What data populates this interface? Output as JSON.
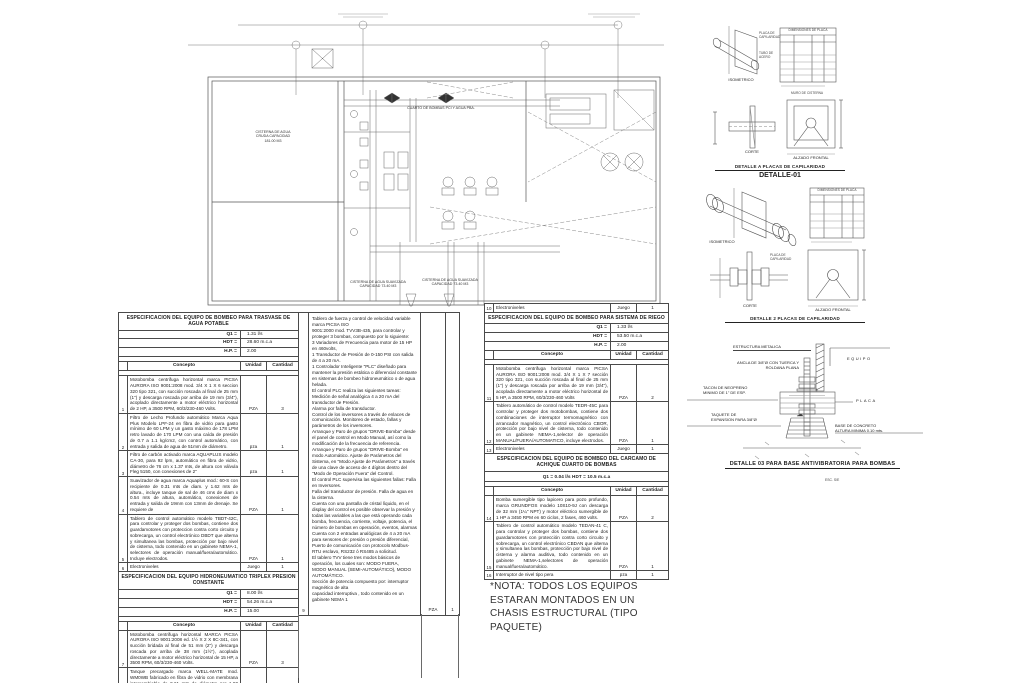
{
  "plan": {
    "cuarto": "CUARTO DE BOMBAS  PCI Y  AGUA PBA.",
    "cisterna_cruda": "CISTERNA DE AGUA\nCRUDA  CAPACIDAD\n181.00 M3",
    "cisterna_suav_1": "CISTERNA DE AGUA SUAVIZADA\nCAPACIDAD 73.40 M3",
    "cisterna_suav_2": "CISTERNA DE AGUA SUAVIZADA\nCAPACIDAD 73.40 M3"
  },
  "t1": {
    "title": "ESPECIFICACION DEL EQUIPO DE BOMBEO PARA TRASVASE DE  AGUA POTABLE",
    "q1l": "Q1 =",
    "q1": "1.31 l/s",
    "hdtl": "HDT =",
    "hdt": "28.60 m.c.a",
    "hpl": "H.P. =",
    "hp": "2.00",
    "hc": "Concepto",
    "hu": "Unidad",
    "hq": "Cantidad",
    "rows": [
      {
        "num": "1",
        "con": "Motobomba centrifuga horizontal marca PICSA AURORA ISO 9001:2008 mod. 3/4 X 1 X 6 seccion 320 tipo 321, con succión roscada al final de 25 mm (1\") y descarga roscada por arriba de 19 mm (3/4\"), acoplado directamente a motor eléctrico horizontal de 2 HP, a 3500 RPM, 60/3/230-460 Volts.",
        "uni": "PZA",
        "qty": "3"
      },
      {
        "num": "2",
        "con": "Filtro de Lecho Profundo automático Marca Aqua Plus Modelo LPF-24 en fibra de vidrio para gasto mínimo de 60 LPM y un gasto máximo de 178 LPM retro lavado de 170 LPM con una caída de presión de 0.7 a 1.1 kg/cm2, con control automático, con entrada y salida de agua de 51mm de diámetro.",
        "uni": "pza",
        "qty": "1"
      },
      {
        "num": "3",
        "con": "Filtro de carbón activado marca AQUAPLUS modelo CA-30, para 92 lpm, automático en fibra de vidrio, diámetro de 76 cm x 1.37 mts, de altura con válvula Fleg 5150, con conexiones de 2\"",
        "uni": "pza",
        "qty": "1"
      },
      {
        "num": "4",
        "con": "Suavizador de agua marca Aquaplus mod.: 60-S con recipiente de 0.31 mts de diam. y 1.62 mts de altura., incluye tanque de sal de 46 cms de diam x 0.54 mts de altura, automático, conexiones de entrada y salida de 19mm con 13mm de drenaje. Se requiere de",
        "uni": "PZA",
        "qty": "1"
      },
      {
        "num": "5",
        "con": "Tablero de control automático modelo TBDT-42C, para controlar y proteger dos bombas, contiene dos guardamotores con proteccion contra corto circuito y sobrecarga, un control electrónico DBDT que alterna y simultanea las bombas, protección por bajo nivel de cisterna, todo contenido en un gabinete NEMA-1, selectores de operación manual/fuera/automático. Incluye electrodos.",
        "uni": "PZA",
        "qty": "1"
      },
      {
        "num": "6",
        "con": "Electroniveles",
        "uni": "Juego",
        "qty": "1"
      }
    ]
  },
  "t2": {
    "title": "ESPECIFICACION DEL EQUIPO HIDRONEUMATICO TRIPLEX PRESION CONSTANTE",
    "q1l": "Q1 =",
    "q1": "8.00 l/s",
    "hdtl": "HDT =",
    "hdt": "54.26 m.c.a",
    "hpl": "H.P. =",
    "hp": "15.00",
    "hc": "Concepto",
    "hu": "Unidad",
    "hq": "Cantidad",
    "rows": [
      {
        "num": "7",
        "con": "Motobomba centrifuga horizontal MARCA PICSA AURORA ISO 9001:2008 ed. 1½ X 2 X 8C-341, con succión bridada al final de 51 mm (2\") y descarga roscada por arriba de 38 mm (1½\"), acoplada directamente a motor eléctrico horizontal de 15 HP, a 3500 RPM, 60/3/230-460 Volts.",
        "uni": "PZA",
        "qty": "3"
      },
      {
        "num": "8",
        "con": "Tanque precargado marca WELL-MATE mod. WM0WB fabricado en fibra de vidrio con membrana intercambiable de 0.61 mts de diámetro por 1.80 mts. de altura para una presión máxima de 8.8 kg/cm2 (125 psig), conexión del sistema de 1-1/4\"NPT y capacidad nominal de 450 lts.",
        "uni": "pza",
        "qty": "1"
      }
    ]
  },
  "mid": {
    "num": "9",
    "uni": "PZA",
    "qty": "1",
    "text": "Tablero de fuerza y control de velocidad variable marca PICSA ISO\n9001:2000 mod. TVV3B-435, para controlar y proteger 3 bombas, compuesto por lo siguiente:\n3 Variadores de Frecuencia para motor de 15 HP en 460volts,\n1 Transductor de Presión de 0-150 PSI con salida de 4 a 20 mA.\n1 Controlador Inteligente \"PLC\" diseñado para mantener la presión estática o diferencial constante en sistemas de bombeo hidroneumático o de agua helada.\nEl control PLC realiza las siguientes tareas:\nMedición de señal analógica 4 a 20 mA del transductor de Presión.\nAlarma por falla de transductor.\nControl de los inversores a través de enlaces de comunicación. Monitoreo de estado, fallas y parámetros de los inversores.\nArranque y Paro de grupos \"DRIVE-Bomba\" desde el panel de control en Modo  Manual, así como la modificación de la frecuencia de referencia.\nArranque y Paro de grupos \"DRIVE-Bomba\" en modo Automático. Ajuste de Parámetros del Sistema, en \"Modo Ajuste de Parámetros\" a través de una clave de acceso de 4 dígitos dentro del \"Modo de Operación Fuera\" del Control.\nEl control PLC supervisa las siguientes fallas: Falla en Inversores.\nFalla del transductor de presión. Falla de agua en la cisterna.\nCuenta con una pantalla de cristal líquido, en el display del control es posible observar la presión y todas las variables a las que está operando cada bomba, frecuencia, corriente, voltaje, potencia, el número de bombas en operación, eventos, alarmas Cuenta con 2 entradas analógicas de 4 a 20 mA para sensores de: presión o presión diferencial, Puerto de comunicación con protocolo Modbus-RTU esclavo, RS232 ó RS485 a solicitud.\nEl tablero TVV tiene tres modos básicos de operación, los cuales son: MODO FUERA,\nMODO MANUAL (SEMI-AUTOMÁTICO), MODO AUTOMÁTICO.\nSección de potencia compuesto por: interruptor magnético de alta\ncapacidad interruptiva , todo contenido en un gabinete NEMA 1"
  },
  "t3": {
    "pre": {
      "num": "10",
      "con": "Electroniveles",
      "uni": "Juego",
      "qty": "1"
    },
    "title": "ESPECIFICACION DEL EQUIPO DE BOMBEO PARA SISTEMA DE RIEGO",
    "q1l": "Q1 =",
    "q1": "1.33 l/s",
    "hdtl": "HDT =",
    "hdt": "53.50 m.c.a",
    "hpl": "H.P. =",
    "hp": "2.00",
    "hc": "Concepto",
    "hu": "Unidad",
    "hq": "Cantidad",
    "rows": [
      {
        "num": "11",
        "con": "Motobomba centrifuga horizontal marca PICSA AURORA ISO 9001:2008 mod. 3/4 X 1 X 7 sección 320 tipo 321, con succión roscada al final de 25 mm (1\") y descarga roscada por arriba de 19 mm (3/4\"), acoplada directamente a motor eléctrico horizontal de 5 HP, a 3500 RPM, 60/3/230-460 Volts",
        "uni": "PZA",
        "qty": "2"
      },
      {
        "num": "12",
        "con": "Tablero automático de control modelo TEDR-45C para controlar y proteger dos motobombas, contiene dos combinaciones de interruptor termomagnético con arrancador magnético, un control electrónico CBOR, protección por bajo nivel de cisterna, todo contenido en un gabinete NEMA-1,selector de operación MANUAL/FUERA/AUTOMATICO, incluye electrodos.",
        "uni": "PZA",
        "qty": "1"
      },
      {
        "num": "13",
        "con": "Electroniveles",
        "uni": "Juego",
        "qty": "1"
      }
    ]
  },
  "t4": {
    "title": "ESPECIFICACION DEL EQUIPO DE BOMBEO DEL CARCAMO  DE ACHIQUE CUARTO DE BOMBAS",
    "params": "Q1 =  0.04 l/s HDT = 10.5 m.c.a",
    "hc": "Concepto",
    "hu": "Unidad",
    "hq": "Cantidad",
    "rows": [
      {
        "num": "14",
        "con": "Bomba sumergible tipo lapicero para pozo profundo, marca GRUNDFOS modelo 10S10-9J con descarga de 32 mm (1¼\" NPT) y motor eléctrico sumergible de 1 HP a 3450 RPM en 60 ciclos, 2 fases, 460 volts.",
        "uni": "PZA",
        "qty": "2"
      },
      {
        "num": "15",
        "con": "Tablero de control automático modelo TEDAN-41 C, para controlar y proteger dos bombas, contiene dos guardamotores con protección contra corto circuito y sobrecarga, un control electrónico CBDAN que alterna y simultanea las bombas, protección por bajo nivel de cisterna y alarma auditiva, todo contenido en un gabinete NEMA-1,selectores de operación manual/fuera/automático.",
        "uni": "PZA",
        "qty": "1"
      },
      {
        "num": "16",
        "con": "Interruptor de nivel tipo pera",
        "uni": "pza",
        "qty": "1"
      }
    ]
  },
  "nota": "*NOTA: TODOS LOS EQUIPOS ESTARAN MONTADOS EN UN CHASIS ESTRUCTURAL (TIPO PAQUETE)",
  "d1": {
    "placa": "PLACA DE\nCAPILARIDAD",
    "tubo": "TUBO DE\nACERO",
    "iso": "ISOMETRICO",
    "dim_title": "DIMENSIONES DE PLACA",
    "muro": "MURO DE CISTERNA",
    "corte": "CORTE",
    "alzado": "ALZADO FRONTAL",
    "title": "DETALLE A PLACAS DE CAPILARIDAD",
    "code": "DETALLE-01"
  },
  "d2": {
    "iso": "ISOMETRICO",
    "dim_title": "DIMENSIONES DE PLACA",
    "placa": "PLACA DE\nCAPILARIDAD",
    "corte": "CORTE",
    "alzado": "ALZADO FRONTAL",
    "title": "DETALLE 2  PLACAS DE CAPILARIDAD"
  },
  "d3": {
    "estructura": "ESTRUCTURA METALICA",
    "ancla": "ANCLA DE 3/8\"Ø CON TUERCA Y\nROLDANA PLANA",
    "tacon": "TACON DE NEOPRENO\nMINIMO DE 1\" DE ESP.",
    "taquete": "TAQUETE DE\nEXPANSION PARA 3/8\"Ø",
    "equipo": "EQUIPO",
    "placa": "PLACA",
    "base": "BASE DE CONCRETO\nALTURA MINIMA 0.10 mts.",
    "title": "DETALLE 03  PARA BASE ANTIVIBRATORIA PARA BOMBAS",
    "esc": "ESC. S/E"
  }
}
